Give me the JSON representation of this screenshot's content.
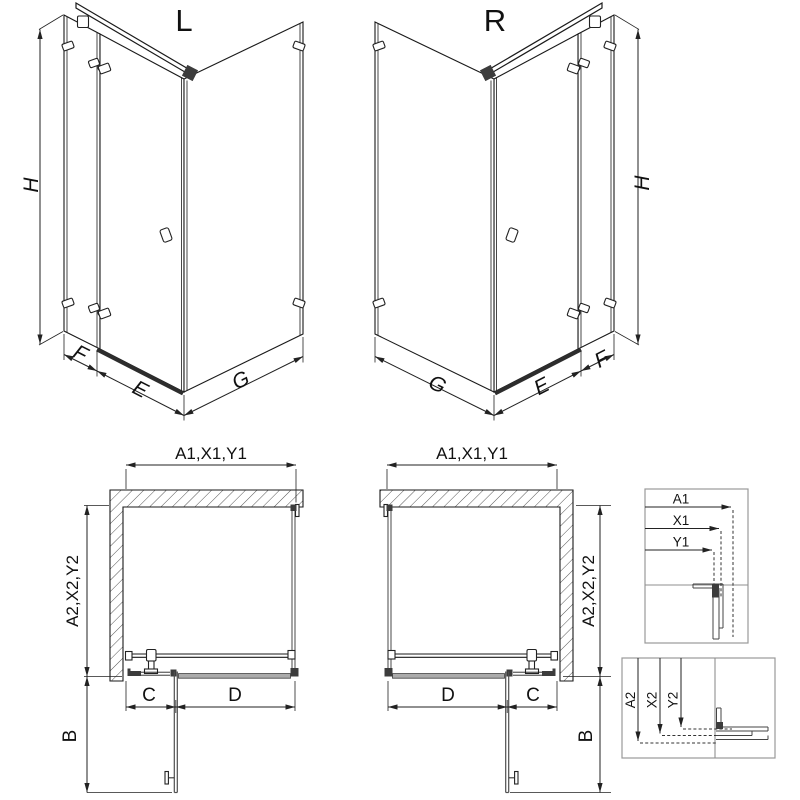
{
  "drawing": {
    "iso_left": {
      "title": "L",
      "dim_height": "H",
      "dim_wall_offset": "F",
      "dim_door_width": "E",
      "dim_side_width": "G"
    },
    "iso_right": {
      "title": "R",
      "dim_height": "H",
      "dim_wall_offset": "F",
      "dim_door_width": "E",
      "dim_side_width": "G"
    },
    "plan_left": {
      "dim_width_top": "A1,X1,Y1",
      "dim_depth_side": "A2,X2,Y2",
      "dim_fixed_segment": "C",
      "dim_door_opening": "D",
      "dim_door_swing": "B"
    },
    "plan_right": {
      "dim_width_top": "A1,X1,Y1",
      "dim_depth_side": "A2,X2,Y2",
      "dim_fixed_segment": "C",
      "dim_door_opening": "D",
      "dim_door_swing": "B"
    },
    "detail_width_box": {
      "labels": [
        "A1",
        "X1",
        "Y1"
      ]
    },
    "detail_depth_box": {
      "labels": [
        "A2",
        "X2",
        "Y2"
      ]
    },
    "colors": {
      "line": "#1a1a1a",
      "box_border": "#999999",
      "threshold_fill": "#ababab",
      "door_gray": "#4f4f4f",
      "hatch": "#555555"
    }
  }
}
